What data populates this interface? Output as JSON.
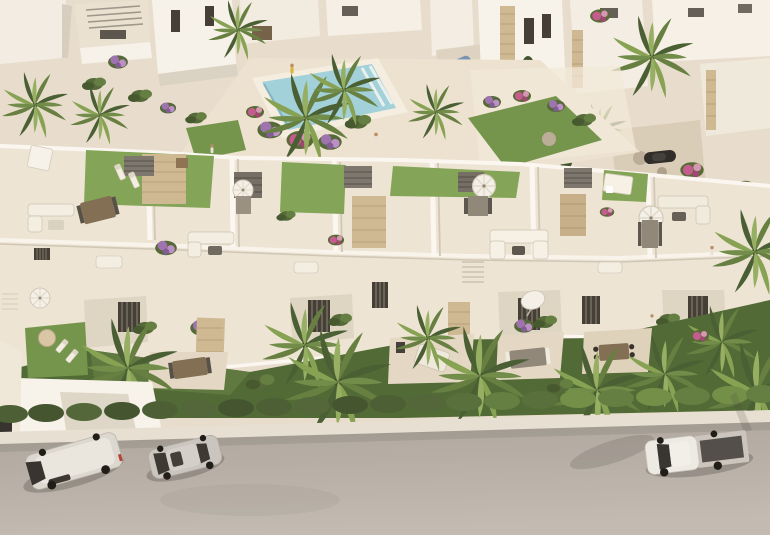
{
  "scene": {
    "type": "aerial-3d-architectural-render",
    "aria_label": "Aerial render of a white Mediterranean residential complex with rooftop terraces, communal pool, palm trees, front gardens, hedge and a street with parked vehicles",
    "inventory": {
      "pool_count": 1,
      "rooftop_turf_terraces": 4,
      "umbrellas": 7,
      "palm_trees": 18,
      "people": 4,
      "background_villas": 10
    },
    "vehicles": [
      {
        "id": "van",
        "type": "panel van",
        "color": "white-silver"
      },
      {
        "id": "hatchback",
        "type": "compact hatchback",
        "color": "silver"
      },
      {
        "id": "pickup",
        "type": "pickup truck",
        "color": "white cab, dark cargo bed"
      },
      {
        "id": "city-car",
        "type": "small city car",
        "color": "blue"
      },
      {
        "id": "sports-car",
        "type": "low car",
        "color": "black"
      }
    ]
  },
  "palette": {
    "paving": "#e7decf",
    "plaza": "#ece3d2",
    "band": "#ece5d6",
    "road": "#b4ada6",
    "sidewalk": "#e6e0d3",
    "pool_water": "#9fd1dd",
    "pool_deck": "#f4efe3",
    "turf": "#7ea253",
    "lawn": "#6e9247",
    "lawn_shadow": "#49652f",
    "hedge": "#44592f",
    "hedge_sunlit": "#6d8c43",
    "wall_sunlit": "#f8f5ee",
    "wall_shadow": "#d6cfc0",
    "stone": "#cdb892",
    "window_dark": "#3b372f",
    "pergola_grey": "#6f6a62",
    "wood": "#7c6a50",
    "white_furniture": "#f3efe5",
    "flower_purple": "#9a6fae",
    "flower_magenta": "#c2558e"
  }
}
